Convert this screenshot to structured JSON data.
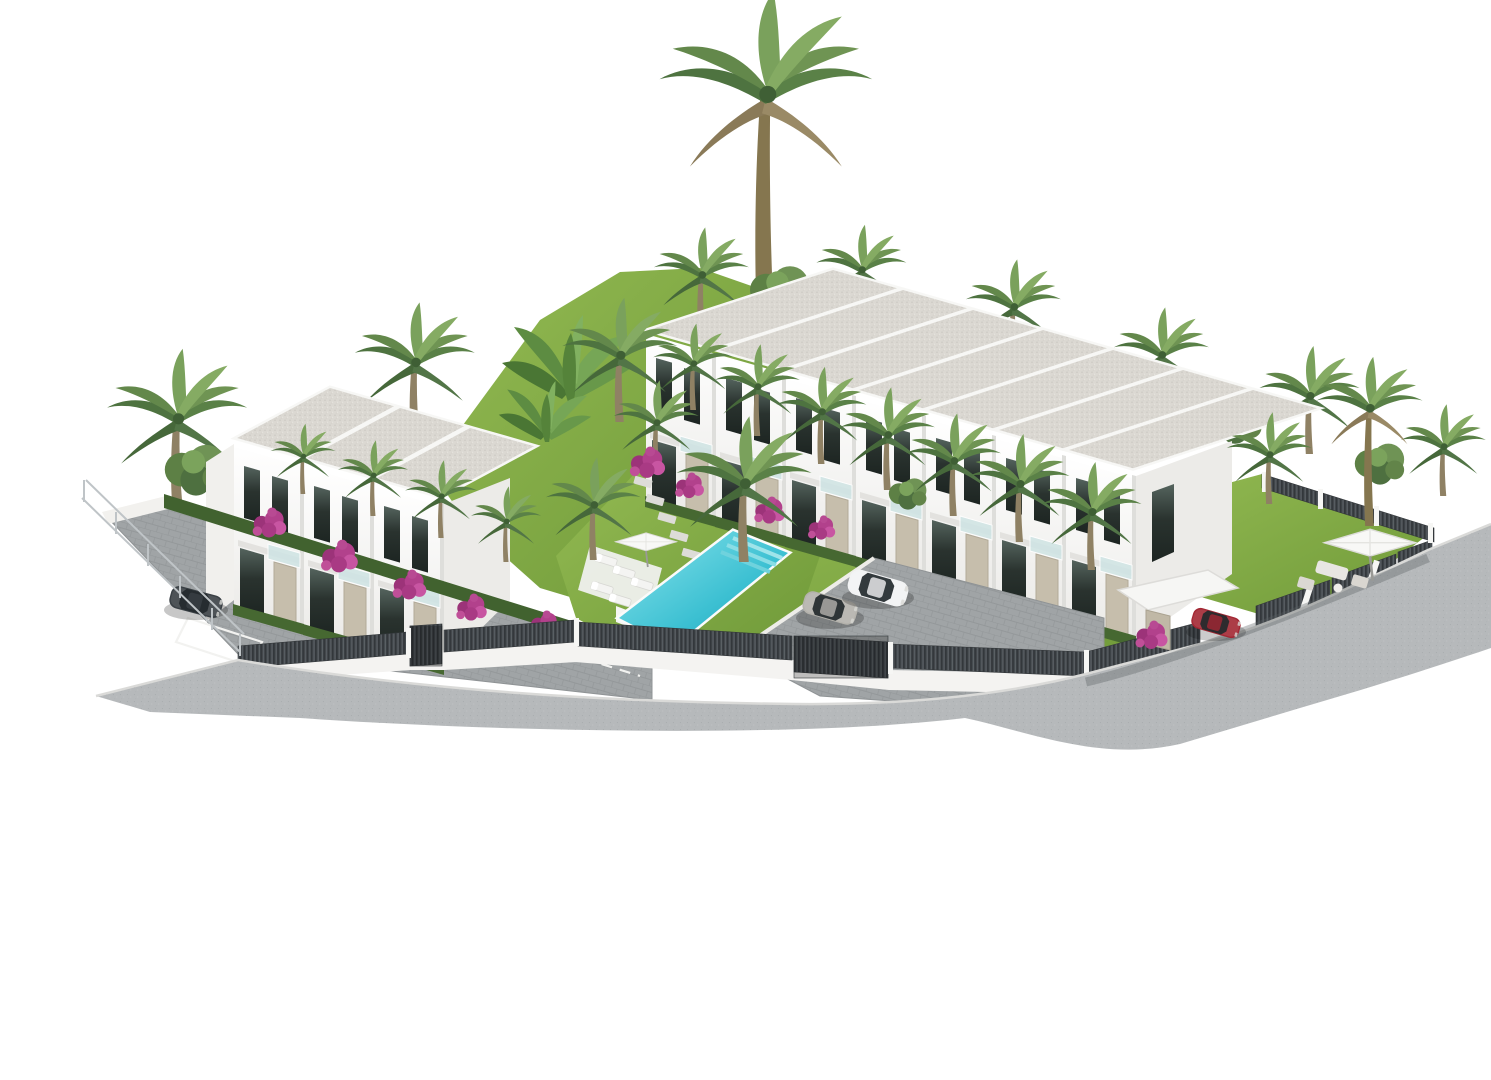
{
  "scene": {
    "type": "3d-architectural-rendering",
    "subject": "Aerial 3D render of a modern white townhouse development with communal pool, landscaped gardens, palm trees, parking court and perimeter fencing, isolated on a white background",
    "background_color": "#ffffff"
  },
  "buildings": {
    "left_block": {
      "label": "left-villa-block",
      "units": 3,
      "floors": 2,
      "roof": "flat gravel with white parapet"
    },
    "right_row": {
      "label": "townhouse-row",
      "units": 7,
      "floors": 2,
      "roof": "flat gravel with white parapet"
    }
  },
  "amenities": {
    "pool": {
      "count": 1,
      "water_color": "#2fb4c8",
      "features": [
        "corner steps",
        "sun loungers",
        "parasol",
        "timber-look surround"
      ]
    },
    "sun_loungers": 5,
    "parasols": 2,
    "garden_lounge_sets": 1
  },
  "vehicles": [
    {
      "label": "dark-gray-car",
      "color": "#3a4045",
      "location": "left driveway"
    },
    {
      "label": "silver-sedan",
      "color": "#b4b2ac",
      "location": "parking court"
    },
    {
      "label": "white-suv",
      "color": "#f2f3f4",
      "location": "parking court"
    },
    {
      "label": "red-car",
      "color": "#a32733",
      "location": "street by right entrance gate"
    }
  ],
  "landscape": {
    "palm_trees_approx": 30,
    "bougainvillea_clusters_approx": 14,
    "bougainvillea_color": "#b2418c",
    "lawn_color": "#7da63f",
    "hedge_color": "#44662f",
    "banana_plants": true
  },
  "infrastructure": {
    "perimeter": "white rendered wall topped with dark slatted fence panels and two taller gates",
    "fence_color": "#45494d",
    "road_color": "#b5b8ba",
    "driveway_color": "#9da1a3",
    "left_boundary": "wire mesh fence",
    "top_right_boundary": "slatted fence with white posts",
    "entry_canopy": "flat white canopy with stone pillar at right entrance"
  },
  "palette": {
    "facade_white": "#fbfbfa",
    "facade_shadow": "#ecebe8",
    "roof_gravel": "#dbd8d2",
    "window_glass_dark": "#2a332f",
    "balcony_glass": "#cfe4e4",
    "stone_cladding": "#c6beac",
    "water_light": "#8ae4ec",
    "water_dark": "#1d9cb6",
    "paver_gray": "#a0a4a6",
    "road_gray": "#b6b9bb",
    "slat_dark": "#474c50"
  }
}
